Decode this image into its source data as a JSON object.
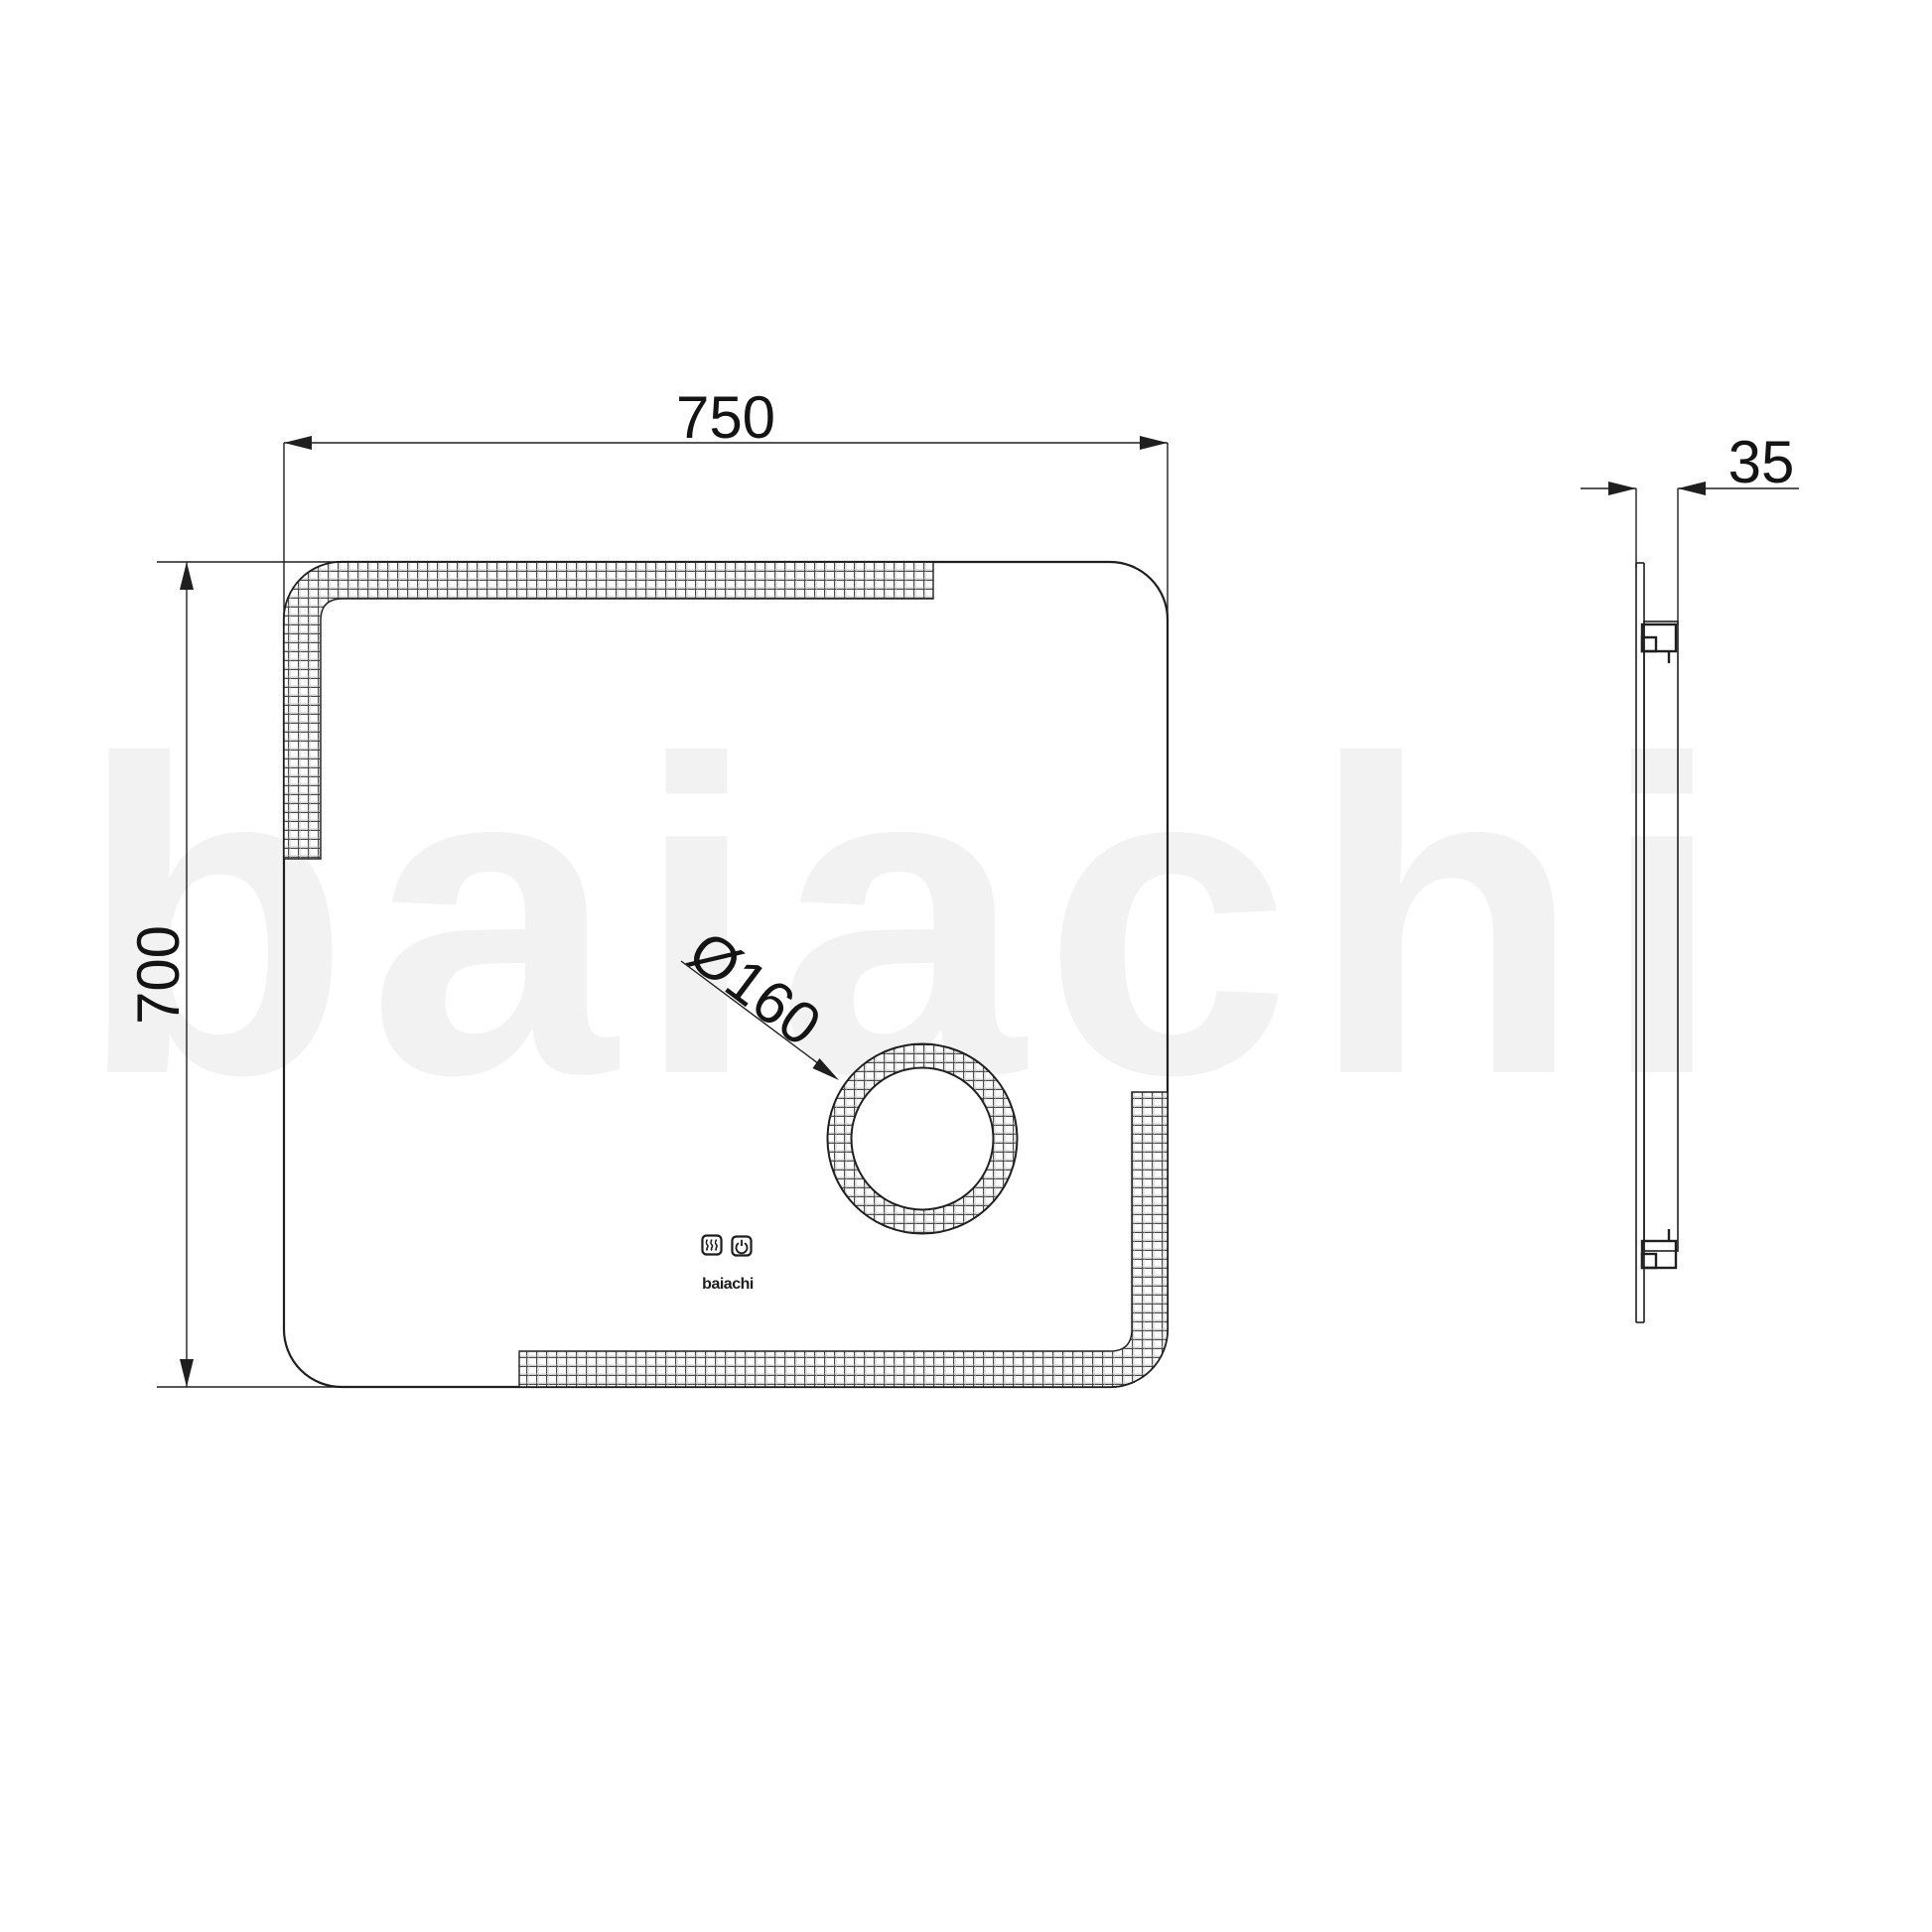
{
  "drawing": {
    "watermark": {
      "text": "baiachi"
    },
    "front_view": {
      "width_dim": "750",
      "height_dim": "700",
      "magnifier_dim": "Ø160",
      "brand": "baiachi",
      "icons": [
        {
          "name": "demister-icon"
        },
        {
          "name": "power-icon"
        }
      ]
    },
    "side_view": {
      "depth_dim": "35"
    },
    "colors": {
      "background": "#ffffff",
      "line": "#1f1f1f",
      "hatch": "#4a4a4a",
      "watermark": "#f2f2f2"
    }
  }
}
